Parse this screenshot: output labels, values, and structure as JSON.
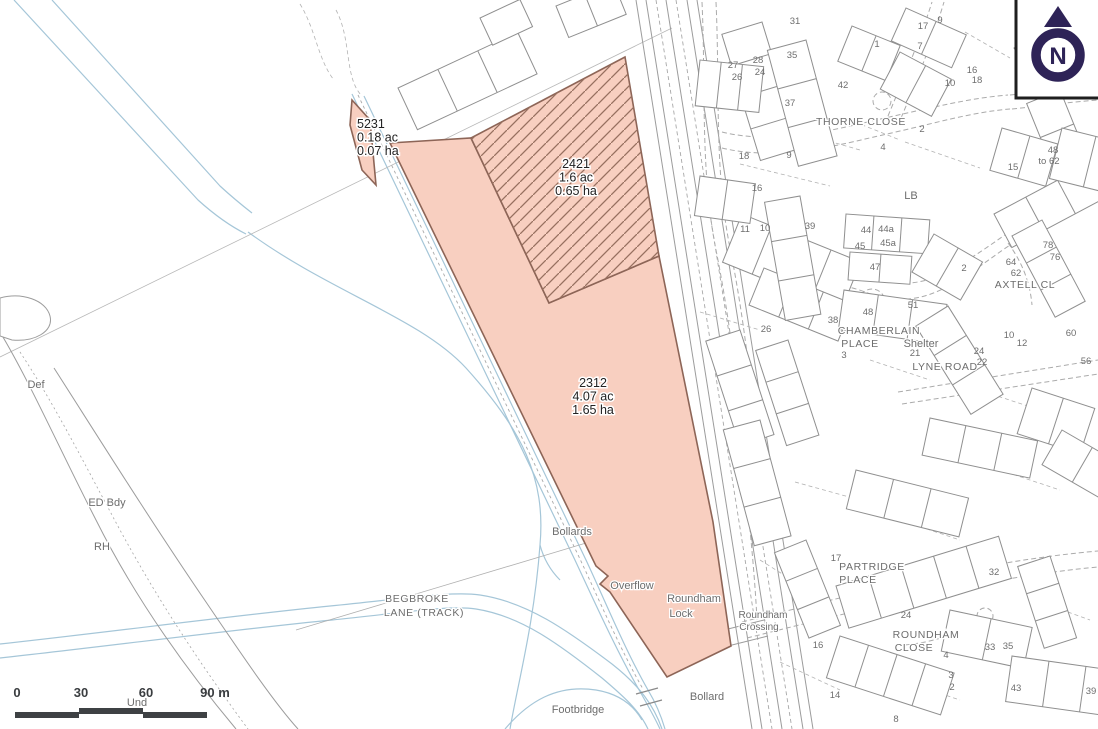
{
  "map": {
    "parcels": [
      {
        "id": "5231",
        "lines": [
          "5231",
          "0.18 ac",
          "0.07 ha"
        ],
        "label_x": 357,
        "label_y": 128,
        "anchor": "start"
      },
      {
        "id": "2421",
        "lines": [
          "2421",
          "1.6 ac",
          "0.65 ha"
        ],
        "label_x": 576,
        "label_y": 168,
        "anchor": "middle"
      },
      {
        "id": "2312",
        "lines": [
          "2312",
          "4.07 ac",
          "1.65 ha"
        ],
        "label_x": 593,
        "label_y": 387,
        "anchor": "middle"
      }
    ],
    "street_labels": [
      {
        "t": "THORNE CLOSE",
        "x": 861,
        "y": 125
      },
      {
        "t": "CHAMBERLAIN",
        "x": 879,
        "y": 334
      },
      {
        "t": "PLACE",
        "x": 860,
        "y": 347
      },
      {
        "t": "LYNE ROAD",
        "x": 945,
        "y": 370
      },
      {
        "t": "AXTELL CL",
        "x": 1025,
        "y": 288
      },
      {
        "t": "PARTRIDGE",
        "x": 872,
        "y": 570
      },
      {
        "t": "PLACE",
        "x": 858,
        "y": 583
      },
      {
        "t": "ROUNDHAM",
        "x": 926,
        "y": 638
      },
      {
        "t": "CLOSE",
        "x": 914,
        "y": 651
      },
      {
        "t": "BEGBROKE",
        "x": 417,
        "y": 602
      },
      {
        "t": "LANE (TRACK)",
        "x": 424,
        "y": 616
      }
    ],
    "feature_labels": [
      {
        "t": "Def",
        "x": 36,
        "y": 388
      },
      {
        "t": "ED Bdy",
        "x": 107,
        "y": 506
      },
      {
        "t": "RH",
        "x": 102,
        "y": 550
      },
      {
        "t": "Und",
        "x": 137,
        "y": 706
      },
      {
        "t": "LB",
        "x": 911,
        "y": 199
      },
      {
        "t": "Shelter",
        "x": 921,
        "y": 347
      },
      {
        "t": "Bollards",
        "x": 572,
        "y": 535
      },
      {
        "t": "Overflow",
        "x": 632,
        "y": 589
      },
      {
        "t": "Roundham",
        "x": 694,
        "y": 602
      },
      {
        "t": "Lock",
        "x": 681,
        "y": 617
      },
      {
        "t": "Roundham",
        "x": 763,
        "y": 618,
        "small": true
      },
      {
        "t": "Crossing",
        "x": 759,
        "y": 630,
        "small": true
      },
      {
        "t": "Bollard",
        "x": 707,
        "y": 700
      },
      {
        "t": "Footbridge",
        "x": 578,
        "y": 713
      }
    ],
    "house_numbers": [
      {
        "t": "31",
        "x": 795,
        "y": 24
      },
      {
        "t": "35",
        "x": 792,
        "y": 58
      },
      {
        "t": "27",
        "x": 733,
        "y": 68
      },
      {
        "t": "28",
        "x": 758,
        "y": 63
      },
      {
        "t": "26",
        "x": 737,
        "y": 80
      },
      {
        "t": "24",
        "x": 760,
        "y": 75
      },
      {
        "t": "37",
        "x": 790,
        "y": 106
      },
      {
        "t": "42",
        "x": 843,
        "y": 88
      },
      {
        "t": "1",
        "x": 877,
        "y": 47
      },
      {
        "t": "7",
        "x": 920,
        "y": 49
      },
      {
        "t": "17",
        "x": 923,
        "y": 29
      },
      {
        "t": "9",
        "x": 940,
        "y": 23
      },
      {
        "t": "43",
        "x": 1058,
        "y": 10
      },
      {
        "t": "51",
        "x": 1062,
        "y": 20
      },
      {
        "t": "16",
        "x": 972,
        "y": 73
      },
      {
        "t": "18",
        "x": 977,
        "y": 83
      },
      {
        "t": "10",
        "x": 950,
        "y": 86
      },
      {
        "t": "2",
        "x": 922,
        "y": 132
      },
      {
        "t": "9",
        "x": 789,
        "y": 158
      },
      {
        "t": "4",
        "x": 883,
        "y": 150
      },
      {
        "t": "16",
        "x": 757,
        "y": 191
      },
      {
        "t": "18",
        "x": 744,
        "y": 159
      },
      {
        "t": "11",
        "x": 745,
        "y": 232
      },
      {
        "t": "10",
        "x": 765,
        "y": 231
      },
      {
        "t": "26",
        "x": 766,
        "y": 332
      },
      {
        "t": "39",
        "x": 810,
        "y": 229
      },
      {
        "t": "44",
        "x": 866,
        "y": 233
      },
      {
        "t": "44a",
        "x": 886,
        "y": 232
      },
      {
        "t": "45",
        "x": 860,
        "y": 249
      },
      {
        "t": "45a",
        "x": 888,
        "y": 246
      },
      {
        "t": "47",
        "x": 875,
        "y": 270
      },
      {
        "t": "48",
        "x": 868,
        "y": 315
      },
      {
        "t": "51",
        "x": 913,
        "y": 308
      },
      {
        "t": "38",
        "x": 833,
        "y": 323
      },
      {
        "t": "3",
        "x": 844,
        "y": 358
      },
      {
        "t": "21",
        "x": 915,
        "y": 356
      },
      {
        "t": "2",
        "x": 964,
        "y": 271
      },
      {
        "t": "64",
        "x": 1011,
        "y": 265
      },
      {
        "t": "62",
        "x": 1016,
        "y": 276
      },
      {
        "t": "78",
        "x": 1048,
        "y": 248
      },
      {
        "t": "76",
        "x": 1055,
        "y": 260
      },
      {
        "t": "15",
        "x": 1013,
        "y": 170
      },
      {
        "t": "48",
        "x": 1053,
        "y": 153
      },
      {
        "t": "to 62",
        "x": 1049,
        "y": 164
      },
      {
        "t": "60",
        "x": 1071,
        "y": 336
      },
      {
        "t": "56",
        "x": 1086,
        "y": 364
      },
      {
        "t": "10",
        "x": 1009,
        "y": 338
      },
      {
        "t": "12",
        "x": 1022,
        "y": 346
      },
      {
        "t": "24",
        "x": 979,
        "y": 354
      },
      {
        "t": "22",
        "x": 982,
        "y": 365
      },
      {
        "t": "17",
        "x": 836,
        "y": 561
      },
      {
        "t": "16",
        "x": 818,
        "y": 648
      },
      {
        "t": "32",
        "x": 994,
        "y": 575
      },
      {
        "t": "24",
        "x": 906,
        "y": 618
      },
      {
        "t": "33",
        "x": 990,
        "y": 650
      },
      {
        "t": "35",
        "x": 1008,
        "y": 649
      },
      {
        "t": "43",
        "x": 1016,
        "y": 691
      },
      {
        "t": "39",
        "x": 1091,
        "y": 694
      },
      {
        "t": "14",
        "x": 835,
        "y": 698
      },
      {
        "t": "4",
        "x": 946,
        "y": 658
      },
      {
        "t": "3",
        "x": 951,
        "y": 678
      },
      {
        "t": "2",
        "x": 952,
        "y": 690
      },
      {
        "t": "8",
        "x": 896,
        "y": 722
      }
    ],
    "scale_bar": {
      "labels": [
        "0",
        "30",
        "60",
        "90 m"
      ]
    },
    "north": {
      "letter": "N"
    },
    "colors": {
      "parcel_fill": "#f8cfc0",
      "parcel_border": "#8d6557",
      "hatch": "#97705f",
      "water": "#a5c6d8",
      "map_line": "#9c9c9c",
      "label_gray": "#6d6d6d",
      "north_navy": "#2e2357",
      "scalebar": "#3e4144"
    }
  }
}
